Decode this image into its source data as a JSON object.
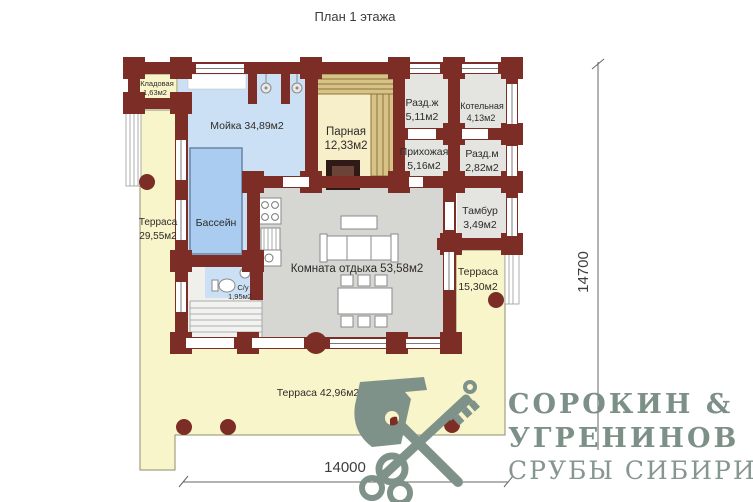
{
  "title": "План 1 этажа",
  "dimensions": {
    "horizontal": "14000",
    "vertical": "14700"
  },
  "rooms": {
    "kladovaya": {
      "name": "Кладовая",
      "area": "1,63м2"
    },
    "moyka": {
      "label": "Мойка 34,89м2"
    },
    "parnaya": {
      "name": "Парная",
      "area": "12,33м2"
    },
    "razd_zh": {
      "name": "Разд.ж",
      "area": "5,11м2"
    },
    "kotelnaya": {
      "name": "Котельная",
      "area": "4,13м2"
    },
    "prihozhaya": {
      "name": "Прихожая",
      "area": "5,16м2"
    },
    "razd_m": {
      "name": "Разд.м",
      "area": "2,82м2"
    },
    "tambur": {
      "name": "Тамбур",
      "area": "3,49м2"
    },
    "bassein": {
      "label": "Бассейн"
    },
    "komnata_otdyha": {
      "label": "Комната отдыха 53,58м2"
    },
    "su": {
      "name": "С/у",
      "area": "1,95м2"
    },
    "terrasa_left": {
      "name": "Терраса",
      "area": "29,55м2"
    },
    "terrasa_right": {
      "name": "Терраса",
      "area": "15,30м2"
    },
    "terrasa_bottom": {
      "label": "Терраса 42,96м2"
    }
  },
  "logo": {
    "line1": "СОРОКИН &",
    "line2": "УГРЕНИНОВ",
    "line3": "СРУБЫ СИБИРИ"
  },
  "icons": {
    "emblem": [
      "axe-icon",
      "key-icon"
    ],
    "fixtures": [
      "shower-icon",
      "stove-icon",
      "sink-icon",
      "toilet-icon",
      "sauna-stove-icon"
    ]
  },
  "colors": {
    "wall": "#7c2e26",
    "terrace": "#f9f5ca",
    "water": "#cbe0f4",
    "pool": "#a9ccf0",
    "sauna_wood": "#d8c386",
    "room_gray": "#e4e4e1",
    "living_gray": "#d6d6d3",
    "logo_green": "#7e928a"
  }
}
